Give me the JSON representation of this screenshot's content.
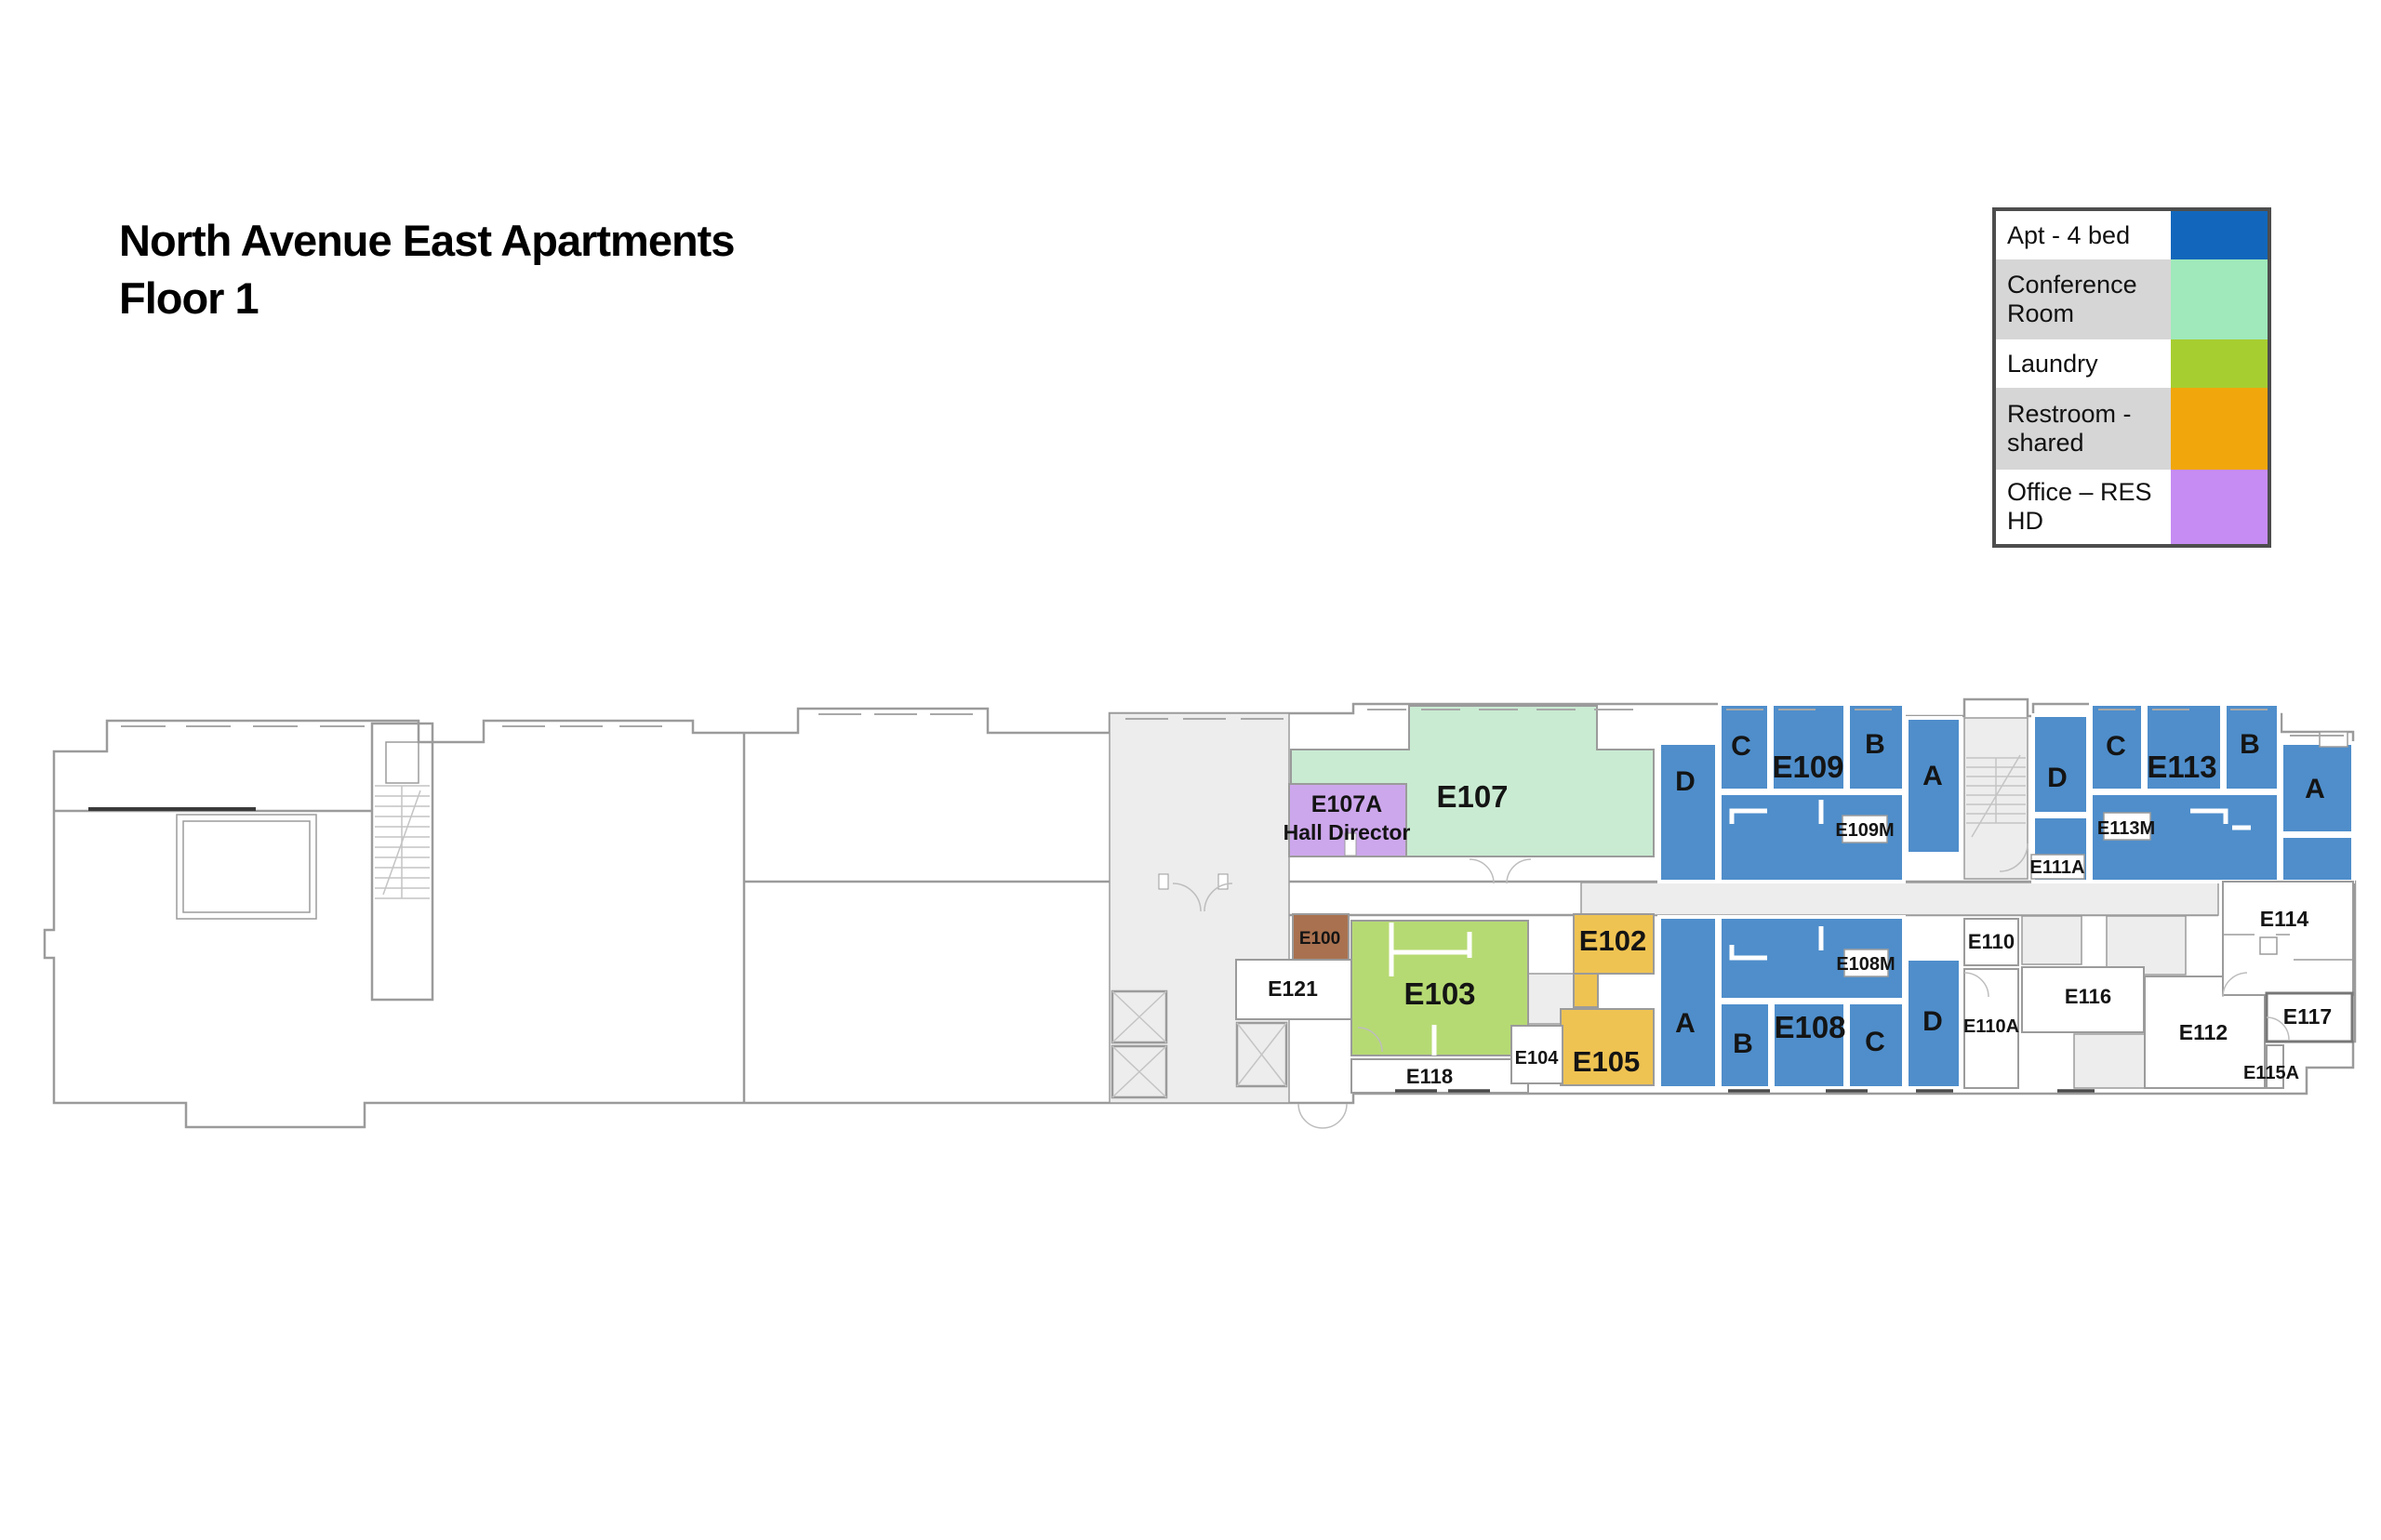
{
  "title": {
    "line1": "North Avenue East Apartments",
    "line2": "Floor 1"
  },
  "legend": {
    "items": [
      {
        "label": "Apt - 4 bed",
        "color": "#1267bc"
      },
      {
        "label": "Conference Room",
        "color": "#9fe9bb"
      },
      {
        "label": "Laundry",
        "color": "#a7ce30"
      },
      {
        "label": "Restroom - shared",
        "color": "#f1a70b"
      },
      {
        "label": "Office – RES HD",
        "color": "#c78cf3"
      }
    ]
  },
  "colors": {
    "apartment": "#4f8ecb",
    "conference": "#c9ebd2",
    "laundry": "#b6da73",
    "restroom": "#efc352",
    "office": "#cda7ec",
    "storage": "#a9714f"
  },
  "rooms": {
    "e107": {
      "label": "E107"
    },
    "e107a": {
      "label": "E107A",
      "sublabel": "Hall Director"
    },
    "e100": {
      "label": "E100"
    },
    "e103": {
      "label": "E103"
    },
    "e102": {
      "label": "E102"
    },
    "e105": {
      "label": "E105"
    },
    "e104": {
      "label": "E104"
    },
    "e118": {
      "label": "E118"
    },
    "e121": {
      "label": "E121"
    },
    "e109": {
      "label": "E109",
      "mech": "E109M",
      "units": {
        "a": "A",
        "b": "B",
        "c": "C",
        "d": "D"
      }
    },
    "e113": {
      "label": "E113",
      "mech": "E113M",
      "units": {
        "a": "A",
        "b": "B",
        "c": "C",
        "d": "D"
      }
    },
    "e108": {
      "label": "E108",
      "mech": "E108M",
      "units": {
        "a": "A",
        "b": "B",
        "c": "C",
        "d": "D"
      }
    },
    "e111a": {
      "label": "E111A"
    },
    "e110": {
      "label": "E110"
    },
    "e110a": {
      "label": "E110A"
    },
    "e116": {
      "label": "E116"
    },
    "e112": {
      "label": "E112"
    },
    "e114": {
      "label": "E114"
    },
    "e117": {
      "label": "E117"
    },
    "e115a": {
      "label": "E115A"
    }
  }
}
